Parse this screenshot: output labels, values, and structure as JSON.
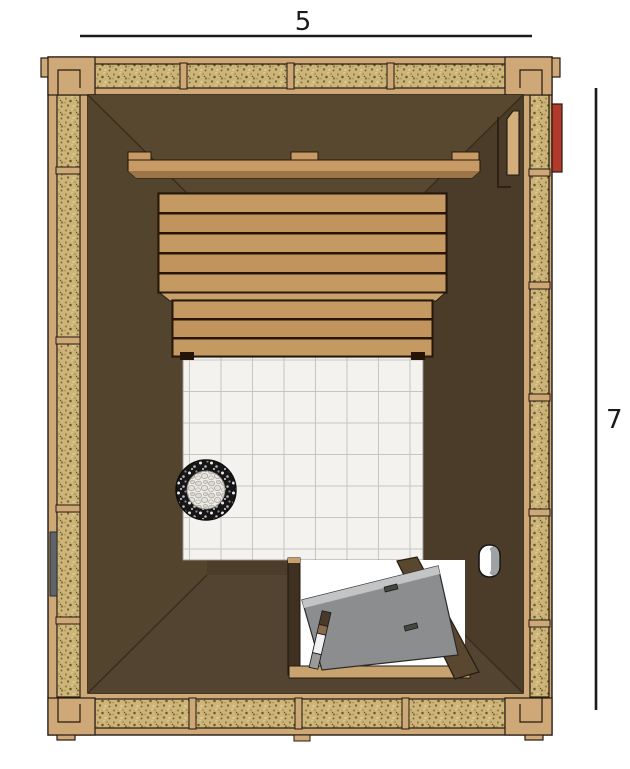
{
  "dimensions": {
    "width_label": "5",
    "height_label": "7"
  },
  "colors": {
    "background": "#ffffff",
    "frame_wood": "#cfa877",
    "insulation_fill": "#cdb47a",
    "interior_wall_dark": "#4d3f2b",
    "bench_wood": "#c49a62",
    "rail_wood": "#c79b63",
    "tile_floor": "#f3f2ef",
    "tile_grout": "#c7c6c1",
    "door_panel_gray": "#8b8d8f",
    "door_jamb_brown": "#5a4730",
    "heater_stone_dark": "#161616",
    "heater_stone_light": "#edebe6",
    "accent_red": "#b23a2a",
    "dimension_line": "#1a1a1a"
  }
}
